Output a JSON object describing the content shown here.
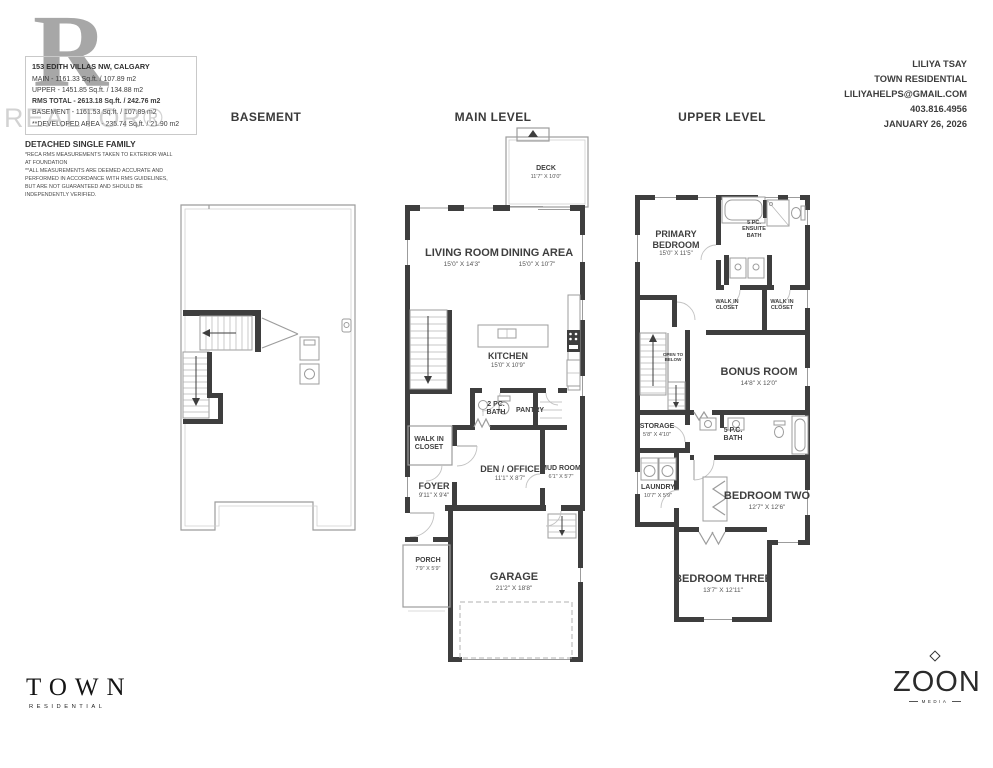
{
  "watermark": {
    "letter": "R",
    "text": "REALTOR®"
  },
  "listing": {
    "address": "153 EDITH VILLAS NW, CALGARY",
    "areas": [
      "MAIN - 1161.33 Sq.ft. / 107.89 m2",
      "UPPER - 1451.85 Sq.ft. / 134.88 m2",
      "RMS TOTAL - 2613.18 Sq.ft. / 242.76 m2",
      "BASEMENT - 1161.53 Sq.ft. / 107.89 m2",
      "**DEVELOPED AREA - 235.74 Sq.ft. / 21.90 m2"
    ],
    "property_type": "DETACHED SINGLE FAMILY",
    "disclaimer": [
      "*RECA RMS MEASUREMENTS TAKEN TO EXTERIOR WALL",
      "AT FOUNDATION",
      "**ALL MEASUREMENTS ARE DEEMED ACCURATE AND",
      "PERFORMED IN ACCORDANCE WITH RMS GUIDELINES,",
      "BUT ARE NOT GUARANTEED AND SHOULD BE",
      "INDEPENDENTLY VERIFIED."
    ]
  },
  "agent": {
    "name": "LILIYA TSAY",
    "company": "TOWN RESIDENTIAL",
    "email": "LILIYAHELPS@GMAIL.COM",
    "phone": "403.816.4956",
    "date": "JANUARY 26, 2026"
  },
  "levels": {
    "basement": "BASEMENT",
    "main": "MAIN LEVEL",
    "upper": "UPPER LEVEL"
  },
  "rooms": {
    "deck": {
      "name": "DECK",
      "dims": "11'7\" X 10'0\""
    },
    "living": {
      "name": "LIVING ROOM",
      "dims": "15'0\" X 14'3\""
    },
    "dining": {
      "name": "DINING AREA",
      "dims": "15'0\" X 10'7\""
    },
    "kitchen": {
      "name": "KITCHEN",
      "dims": "15'0\" X 10'9\""
    },
    "bath2": {
      "name": "2 PC.",
      "name2": "BATH"
    },
    "pantry": {
      "name": "PANTRY"
    },
    "wicmain": {
      "name": "WALK IN",
      "name2": "CLOSET"
    },
    "den": {
      "name": "DEN / OFFICE",
      "dims": "11'1\" X 8'7\""
    },
    "mud": {
      "name": "MUD ROOM",
      "dims": "6'1\" X 5'7\""
    },
    "foyer": {
      "name": "FOYER",
      "dims": "9'11\" X 9'4\""
    },
    "porch": {
      "name": "PORCH",
      "dims": "7'9\" X 5'9\""
    },
    "garage": {
      "name": "GARAGE",
      "dims": "21'2\" X 18'8\""
    },
    "primary": {
      "name": "PRIMARY",
      "name2": "BEDROOM",
      "dims": "15'0\" X 11'5\""
    },
    "ensuite": {
      "name": "5 PC.",
      "name2": "ENSUITE",
      "name3": "BATH"
    },
    "wic1": {
      "name": "WALK IN",
      "name2": "CLOSET"
    },
    "wic2": {
      "name": "WALK IN",
      "name2": "CLOSET"
    },
    "open": {
      "name": "OPEN TO",
      "name2": "BELOW"
    },
    "bonus": {
      "name": "BONUS ROOM",
      "dims": "14'8\" X 12'0\""
    },
    "storage": {
      "name": "STORAGE",
      "dims": "5'8\" X 4'10\""
    },
    "bath5": {
      "name": "5 P.C.",
      "name2": "BATH"
    },
    "laundry": {
      "name": "LAUNDRY",
      "dims": "10'7\" X 5'9\""
    },
    "bed2": {
      "name": "BEDROOM TWO",
      "dims": "12'7\" X 12'6\""
    },
    "bed3": {
      "name": "BEDROOM THREE",
      "dims": "13'7\" X 12'11\""
    }
  },
  "logos": {
    "town": {
      "name": "TOWN",
      "sub": "RESIDENTIAL"
    },
    "zoon": {
      "name": "ZOON",
      "sub": "MEDIA"
    }
  }
}
